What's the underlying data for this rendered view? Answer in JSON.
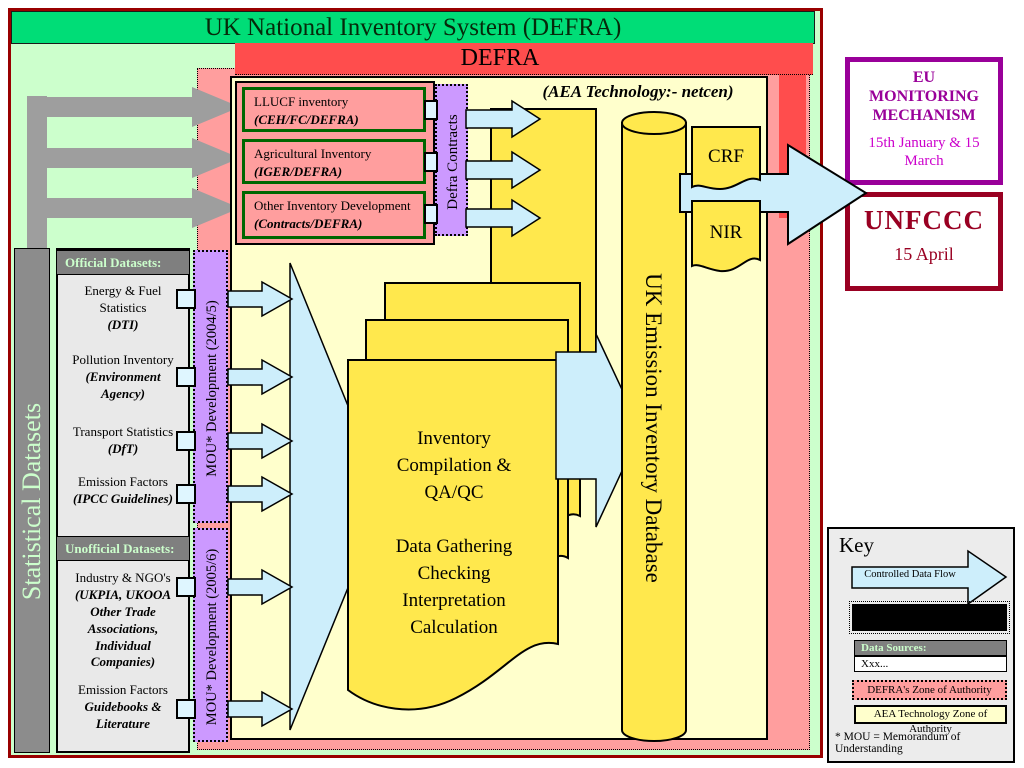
{
  "slide": {
    "banner": "UK National Inventory System (DEFRA)"
  },
  "defra": {
    "banner": "DEFRA",
    "aea_note": "(AEA Technology:- netcen)",
    "contracts_bar": "Defra Contracts",
    "contract_boxes": [
      {
        "name": "LLUCF inventory",
        "org": "(CEH/FC/DEFRA)"
      },
      {
        "name": "Agricultural Inventory",
        "org": "(IGER/DEFRA)"
      },
      {
        "name": "Other Inventory Development",
        "org": "(Contracts/DEFRA)"
      }
    ]
  },
  "process": {
    "text": "Inventory\nCompilation &\nQA/QC\n\nData Gathering\nChecking\nInterpretation\nCalculation"
  },
  "database": {
    "label": "UK Emission Inventory Database"
  },
  "outputs": {
    "crf": "CRF",
    "nir": "NIR"
  },
  "eu_box": {
    "title": "EU\nMONITORING\nMECHANISM",
    "dates": "15th January & 15\nMarch"
  },
  "unfccc_box": {
    "title": "UNFCCC",
    "date": "15 April"
  },
  "datasets": {
    "sidebar_label": "Statistical Datasets",
    "official_header": "Official Datasets:",
    "unofficial_header": "Unofficial Datasets:",
    "items": [
      {
        "name": "Energy & Fuel\nStatistics",
        "source": "(DTI)"
      },
      {
        "name": "Pollution Inventory",
        "source": "(Environment\nAgency)"
      },
      {
        "name": "Transport Statistics",
        "source": "(DfT)"
      },
      {
        "name": "Emission Factors",
        "source": "(IPCC Guidelines)"
      },
      {
        "name": "Industry & NGO's",
        "source": "(UKPIA, UKOOA\nOther Trade\nAssociations,\nIndividual\nCompanies)"
      },
      {
        "name": "Emission Factors",
        "source": "Guidebooks &\nLiterature"
      }
    ]
  },
  "mou": {
    "bar_2004": "MOU* Development (2004/5)",
    "bar_2005": "MOU* Development (2005/6)"
  },
  "key": {
    "title": "Key",
    "controlled_flow": "Controlled Data Flow",
    "data_sources": "Data Sources:",
    "data_sources_example": "Xxx...",
    "defra_zone": "DEFRA's Zone of Authority",
    "aea_zone": "AEA Technology Zone of Authority",
    "mou_note": "* MOU = Memorandum of Understanding"
  },
  "colors": {
    "banner_green": "#00dd77",
    "defra_red": "#ff4d4d",
    "zone_pink": "#ff9e9e",
    "mou_purple": "#cc99ff",
    "aea_pale_yellow": "#ffffcc",
    "item_yellow": "#ffe84d",
    "flow_cyan": "#cdeefb",
    "eu_purple": "#990099",
    "unfccc_red": "#990022",
    "slide_border_red": "#990000"
  }
}
